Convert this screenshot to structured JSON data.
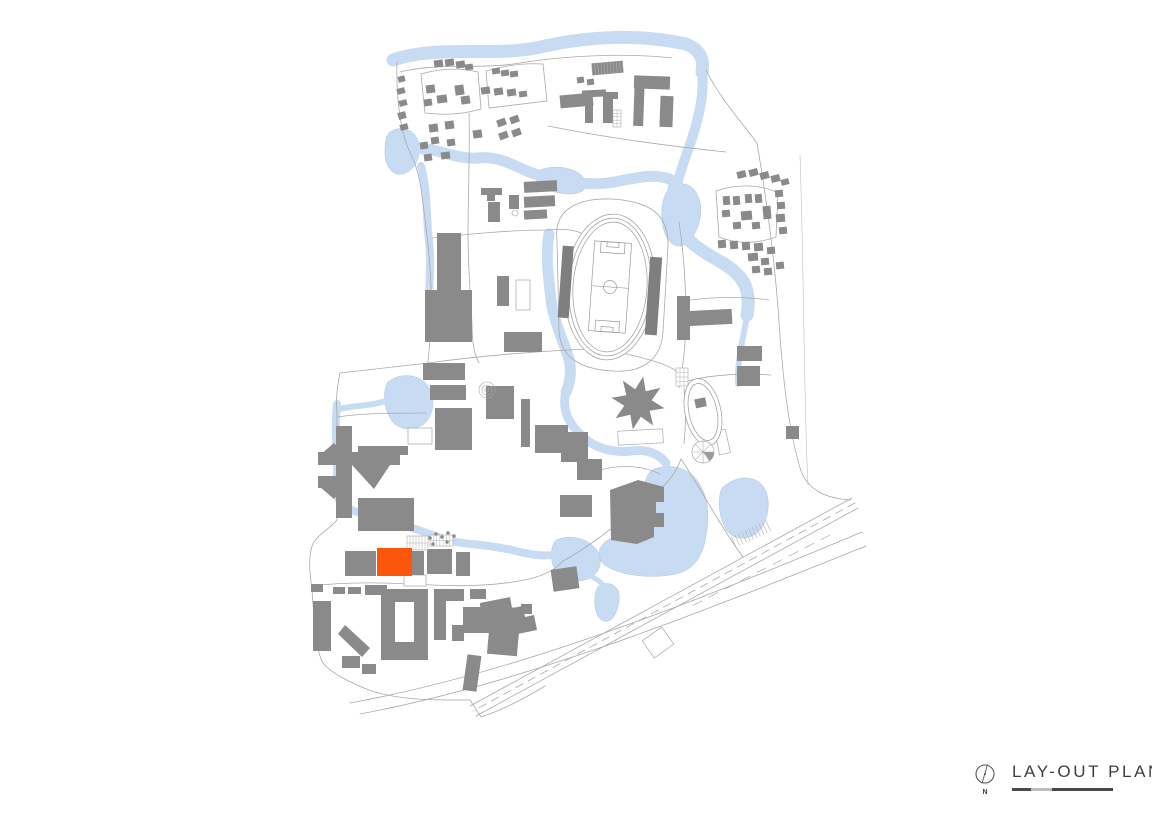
{
  "legend": {
    "title": "LAY-OUT PLAN",
    "north_label": "N"
  },
  "colors": {
    "water": "#C7DCF3",
    "water_edge": "#AFC6DE",
    "building": "#8A8A8A",
    "building_dark": "#7F7F7F",
    "road": "#A9A9A9",
    "road_light": "#BFBFBF",
    "highlight": "#FA560C",
    "text": "#3E3E3E",
    "white": "#FFFFFF"
  },
  "map": {
    "water_fills": [
      "M390,132 C402,124 416,130 419,144 C421,158 414,172 402,174 C391,176 384,164 385,150 C385,142 386,135 390,132 Z",
      "M388,382 C400,372 420,374 428,386 C436,398 434,415 424,424 C412,432 396,430 390,418 C384,408 382,392 388,382 Z",
      "M652,470 C670,462 690,468 699,483 C708,497 710,516 706,536 C703,556 694,570 676,574 C652,579 622,576 606,566 C596,559 597,546 608,540 C622,532 636,524 640,508 C643,492 644,476 652,470 Z",
      "M556,540 C570,534 588,538 597,550 C603,560 601,572 590,578 C578,584 561,580 555,570 C550,561 550,546 556,540 Z",
      "M600,585 C612,580 621,588 619,601 C617,614 612,623 604,621 C596,619 594,606 595,596 C596,590 597,587 600,585 Z",
      "M722,488 C734,476 754,474 763,486 C771,497 769,515 763,526 C756,538 740,542 730,534 C720,526 716,500 722,488 Z",
      "M668,190 C678,180 692,182 698,196 C704,210 700,226 692,238 C684,250 672,248 666,236 C660,224 660,200 668,190 Z",
      "M540,170 C556,164 576,168 584,178 C590,186 584,194 570,194 C556,194 540,188 536,180 C534,175 536,172 540,170 Z"
    ],
    "water_strokes": [
      {
        "d": "M393,60 C440,44 500,58 545,46 C590,36 640,34 686,44 C701,50 704,60 702,72",
        "w": 13
      },
      {
        "d": "M702,70 C705,95 698,122 688,150 C682,167 678,180 674,194",
        "w": 10
      },
      {
        "d": "M676,182 C668,206 674,228 692,243 C708,257 726,262 738,275 C748,285 750,300 747,315",
        "w": 13
      },
      {
        "d": "M747,315 C744,336 737,358 738,384",
        "w": 6
      },
      {
        "d": "M400,150 C432,143 452,160 477,158 C506,155 520,172 546,177 C572,183 592,186 614,182 C636,178 656,172 674,181",
        "w": 11
      },
      {
        "d": "M421,166 C428,192 426,217 429,242 C432,267 428,292 429,314",
        "w": 8
      },
      {
        "d": "M549,234 C545,258 549,280 551,300 C553,318 562,338 568,356 C572,368 571,380 566,392",
        "w": 11
      },
      {
        "d": "M566,392 C561,410 570,425 582,436 C594,448 612,453 631,451 C646,449 658,453 666,463",
        "w": 9
      },
      {
        "d": "M337,404 C334,430 338,458 337,483 C336,499 341,507 349,511",
        "w": 8
      },
      {
        "d": "M388,400 C370,407 352,405 340,409",
        "w": 6
      },
      {
        "d": "M349,509 C369,517 389,521 409,527 C429,533 445,541 463,543 C481,545 501,547 516,551 C531,555 546,557 559,554",
        "w": 8
      },
      {
        "d": "M592,577 C598,580 602,582 605,588",
        "w": 5
      }
    ],
    "roads": [
      {
        "d": "M397,62 C396,96 400,128 408,148 C418,168 420,180 422,196 C426,226 430,256 431,286 C432,316 430,341 428,363 L340,373 C336,393 336,403 337,413 L337,520 C330,529 316,535 312,546 C308,561 310,576 312,589 C314,621 316,651 323,663 C331,673 351,683 369,690 C391,698 421,700 449,700 L470,700 L481,717 C505,709 525,698 545,686"
      },
      {
        "d": "M421,74 C441,68 461,68 478,72 L481,109 C461,115 441,115 425,113 L421,74"
      },
      {
        "d": "M486,71 C506,65 526,63 543,64 L547,101 L489,108 L486,71"
      },
      {
        "d": "M469,113 C470,151 468,201 468,233 C468,263 470,293 472,323 C472,342 474,354 479,363"
      },
      {
        "d": "M432,238 C470,234 510,230 546,230 C562,229 572,229 581,233"
      },
      {
        "d": "M428,363 C480,356 530,352 568,350 C602,348 622,352 650,360 C672,366 681,373 687,381"
      },
      {
        "d": "M557,240 C553,208 580,198 611,199 C648,201 669,213 668,246 L663,332 C661,361 641,373 612,371 C583,369 561,360 559,331 L557,240"
      },
      {
        "d": "M679,222 C685,262 687,302 685,342 C684,362 681,374 679,388"
      },
      {
        "d": "M706,70 C721,100 741,121 757,143"
      },
      {
        "d": "M757,143 C767,202 775,262 779,322 C783,382 789,432 801,471 C809,492 830,499 851,500"
      },
      {
        "d": "M684,301 C710,297 740,296 769,300"
      },
      {
        "d": "M687,381 C711,375 741,373 771,375"
      },
      {
        "d": "M312,586 C352,581 392,583 432,585 C472,587 502,585 529,579 C546,575 556,569 563,561"
      },
      {
        "d": "M563,561 C591,546 621,521 649,499 C669,483 677,471 681,459"
      },
      {
        "d": "M681,459 C693,477 707,501 719,521 C729,537 737,549 743,557"
      },
      {
        "d": "M337,417 C365,413 395,413 426,413"
      },
      {
        "d": "M852,498 L470,706"
      },
      {
        "d": "M858,508 L476,716"
      },
      {
        "d": "M350,703 C520,672 700,600 862,532"
      },
      {
        "d": "M360,714 C530,682 706,610 866,546"
      },
      {
        "d": "M400,72 C440,62 480,70 520,63 C556,57 620,52 672,58"
      },
      {
        "d": "M716,191 C740,183 762,185 778,193 L776,237 C754,245 734,243 719,237 L716,191"
      },
      {
        "d": "M684,388 C686,408 686,426 684,444"
      },
      {
        "d": "M548,126 C608,138 668,146 726,152"
      },
      {
        "d": "M600,470 C622,464 644,466 660,474"
      },
      {
        "d": "M800,155 C802,215 803,275 804,335 C805,395 806,445 808,485",
        "w": 0.6,
        "c": "#C0C0C0"
      },
      {
        "d": "M855,503 L473,711",
        "dash": "8,6"
      },
      {
        "d": "M830,535 L688,608",
        "dash": "10,8",
        "w": 0.7
      }
    ],
    "outlines": [
      [
        408,
        428,
        24,
        16,
        0
      ],
      [
        404,
        575,
        22,
        11,
        0
      ],
      [
        516,
        280,
        14,
        30,
        0
      ],
      [
        646,
        632,
        24,
        21,
        -35
      ],
      [
        618,
        430,
        45,
        14,
        -3
      ],
      [
        717,
        430,
        11,
        24,
        -12
      ]
    ],
    "buildings": [
      [
        398,
        76,
        7,
        6,
        -15
      ],
      [
        397,
        88,
        8,
        6,
        -15
      ],
      [
        399,
        100,
        8,
        6,
        -15
      ],
      [
        398,
        112,
        8,
        7,
        -15
      ],
      [
        400,
        124,
        8,
        6,
        -15
      ],
      [
        434,
        60,
        9,
        7,
        -8
      ],
      [
        445,
        59,
        9,
        7,
        -8
      ],
      [
        456,
        61,
        9,
        7,
        -8
      ],
      [
        465,
        64,
        8,
        6,
        -8
      ],
      [
        492,
        68,
        8,
        6,
        -8
      ],
      [
        501,
        70,
        8,
        6,
        -8
      ],
      [
        510,
        71,
        8,
        6,
        -8
      ],
      [
        426,
        85,
        9,
        8,
        -8
      ],
      [
        437,
        95,
        10,
        8,
        -8
      ],
      [
        424,
        99,
        8,
        7,
        -8
      ],
      [
        455,
        85,
        9,
        10,
        -8
      ],
      [
        461,
        96,
        9,
        8,
        -8
      ],
      [
        481,
        87,
        9,
        7,
        -8
      ],
      [
        494,
        88,
        9,
        7,
        -8
      ],
      [
        507,
        89,
        9,
        7,
        -8
      ],
      [
        519,
        91,
        8,
        6,
        -8
      ],
      [
        429,
        124,
        9,
        8,
        -8
      ],
      [
        445,
        121,
        9,
        8,
        -8
      ],
      [
        431,
        137,
        8,
        7,
        -8
      ],
      [
        447,
        139,
        8,
        7,
        -8
      ],
      [
        420,
        142,
        8,
        7,
        -8
      ],
      [
        424,
        154,
        8,
        7,
        -8
      ],
      [
        441,
        152,
        9,
        7,
        -8
      ],
      [
        473,
        130,
        9,
        8,
        -8
      ],
      [
        497,
        119,
        9,
        7,
        -20
      ],
      [
        510,
        116,
        9,
        7,
        -20
      ],
      [
        499,
        132,
        9,
        7,
        -20
      ],
      [
        512,
        129,
        9,
        7,
        -20
      ],
      [
        560,
        94,
        33,
        13,
        -5
      ],
      [
        577,
        77,
        7,
        6,
        -8
      ],
      [
        587,
        79,
        7,
        6,
        -8
      ],
      [
        582,
        90,
        24,
        7,
        -3
      ],
      [
        585,
        101,
        8,
        22,
        0
      ],
      [
        603,
        94,
        10,
        29,
        0
      ],
      [
        603,
        92,
        15,
        7,
        0
      ],
      [
        592,
        62,
        31,
        12,
        -5
      ],
      [
        634,
        76,
        10,
        50,
        2
      ],
      [
        634,
        76,
        36,
        13,
        2
      ],
      [
        660,
        96,
        13,
        31,
        2
      ],
      [
        481,
        188,
        21,
        7,
        0
      ],
      [
        487,
        195,
        8,
        6,
        0
      ],
      [
        488,
        202,
        12,
        20,
        0
      ],
      [
        509,
        195,
        10,
        14,
        0
      ],
      [
        524,
        181,
        33,
        11,
        -3
      ],
      [
        524,
        196,
        31,
        11,
        -3
      ],
      [
        524,
        210,
        23,
        9,
        -3
      ],
      [
        737,
        171,
        9,
        7,
        -15
      ],
      [
        749,
        169,
        9,
        7,
        -15
      ],
      [
        760,
        172,
        9,
        7,
        -15
      ],
      [
        771,
        175,
        9,
        7,
        -15
      ],
      [
        781,
        179,
        8,
        6,
        -15
      ],
      [
        723,
        196,
        7,
        9,
        -5
      ],
      [
        733,
        196,
        7,
        9,
        -5
      ],
      [
        745,
        194,
        7,
        9,
        -5
      ],
      [
        755,
        194,
        7,
        9,
        -5
      ],
      [
        722,
        210,
        8,
        7,
        -5
      ],
      [
        741,
        211,
        11,
        9,
        -5
      ],
      [
        733,
        222,
        8,
        7,
        -5
      ],
      [
        752,
        222,
        8,
        7,
        -5
      ],
      [
        775,
        190,
        8,
        7,
        -5
      ],
      [
        777,
        202,
        8,
        7,
        -5
      ],
      [
        776,
        214,
        9,
        8,
        -5
      ],
      [
        779,
        227,
        8,
        7,
        -5
      ],
      [
        763,
        206,
        8,
        13,
        -5
      ],
      [
        718,
        240,
        8,
        8,
        -5
      ],
      [
        730,
        241,
        8,
        8,
        -5
      ],
      [
        742,
        242,
        8,
        8,
        -5
      ],
      [
        754,
        243,
        9,
        8,
        -5
      ],
      [
        767,
        247,
        8,
        7,
        -5
      ],
      [
        748,
        253,
        10,
        8,
        -5
      ],
      [
        761,
        258,
        8,
        7,
        -5
      ],
      [
        752,
        266,
        8,
        7,
        -5
      ],
      [
        764,
        268,
        8,
        7,
        -5
      ],
      [
        776,
        262,
        8,
        7,
        -5
      ],
      [
        437,
        233,
        24,
        58,
        0
      ],
      [
        425,
        290,
        47,
        52,
        0
      ],
      [
        497,
        276,
        12,
        30,
        0
      ],
      [
        504,
        332,
        38,
        20,
        0
      ],
      [
        423,
        363,
        42,
        17,
        0
      ],
      [
        430,
        385,
        36,
        15,
        0
      ],
      [
        445,
        425,
        17,
        20,
        0
      ],
      [
        486,
        386,
        28,
        33,
        0
      ],
      [
        521,
        399,
        9,
        48,
        0
      ],
      [
        435,
        408,
        37,
        42,
        0
      ],
      [
        535,
        425,
        33,
        28,
        0
      ],
      [
        561,
        432,
        27,
        30,
        0
      ],
      [
        577,
        459,
        25,
        21,
        0
      ],
      [
        560,
        495,
        32,
        22,
        0
      ],
      [
        336,
        426,
        16,
        92,
        0
      ],
      [
        318,
        452,
        20,
        13,
        0
      ],
      [
        318,
        476,
        20,
        12,
        0
      ],
      [
        352,
        452,
        48,
        13,
        0
      ],
      [
        358,
        446,
        50,
        9,
        0
      ],
      [
        358,
        498,
        56,
        33,
        0
      ],
      [
        345,
        551,
        31,
        25,
        0
      ],
      [
        411,
        551,
        13,
        24,
        0
      ],
      [
        427,
        549,
        25,
        25,
        0
      ],
      [
        456,
        552,
        14,
        24,
        0
      ],
      [
        688,
        310,
        44,
        15,
        -3
      ],
      [
        737,
        346,
        25,
        15,
        0
      ],
      [
        737,
        366,
        23,
        20,
        0
      ],
      [
        677,
        296,
        13,
        44,
        0
      ],
      [
        786,
        426,
        13,
        13,
        0
      ],
      [
        311,
        584,
        12,
        8,
        0
      ],
      [
        333,
        587,
        12,
        7,
        0
      ],
      [
        348,
        587,
        13,
        7,
        0
      ],
      [
        365,
        585,
        22,
        10,
        0
      ],
      [
        313,
        601,
        18,
        50,
        0
      ],
      [
        381,
        589,
        47,
        13,
        0
      ],
      [
        381,
        602,
        14,
        40,
        0
      ],
      [
        414,
        602,
        14,
        40,
        0
      ],
      [
        381,
        642,
        47,
        18,
        0
      ],
      [
        434,
        589,
        30,
        12,
        0
      ],
      [
        434,
        598,
        12,
        42,
        0
      ],
      [
        452,
        625,
        12,
        16,
        0
      ],
      [
        470,
        589,
        16,
        10,
        0
      ],
      [
        463,
        607,
        36,
        26,
        0
      ],
      [
        489,
        607,
        30,
        48,
        5
      ],
      [
        465,
        655,
        14,
        36,
        8
      ],
      [
        521,
        604,
        11,
        10,
        0
      ],
      [
        342,
        656,
        18,
        12,
        0
      ],
      [
        362,
        664,
        14,
        10,
        0
      ],
      [
        552,
        568,
        26,
        22,
        -8
      ]
    ],
    "building_paths": [
      "M345,625 L370,648 L362,657 L338,634 Z",
      "M352,465 L392,462 L374,489 Z",
      "M320,455 L334,443 L341,451 L327,463 Z",
      "M320,487 L334,499 L341,491 L327,479 Z",
      "M664.5,408.2 L649.7,410.7 L653.1,425.4 L640.8,416.7 L632.8,429.5 L630.3,414.7 L615.6,418.1 L624.3,405.8 L611.5,397.8 L626.3,395.3 L622.9,380.6 L635.2,389.3 L643.2,376.5 L645.7,391.3 L660.4,387.9 L651.7,400.2 Z",
      "M610,490 L638,480 L664,487 L664,502 L656,502 L656,513 L664,513 L664,527 L654,527 L654,537 L637,544 L611,540 Z",
      "M480,603 L510,597 L512,608 L523,606 L525,617 L534,615 L537,630 L498,638 L481,629 Z"
    ],
    "stadium": {
      "cx": 610,
      "cy": 287,
      "rot": 4,
      "rings": [
        [
          45,
          73
        ],
        [
          41,
          69
        ],
        [
          37,
          65
        ]
      ],
      "field": [
        591.5,
        242,
        37,
        90
      ],
      "boxes": [
        [
          598,
          242,
          24,
          11
        ],
        [
          604,
          242,
          12,
          5
        ],
        [
          598,
          321,
          24,
          11
        ],
        [
          604,
          327,
          12,
          5
        ]
      ],
      "center_circle_r": 6.5,
      "stands": [
        [
          560,
          249,
          11,
          72
        ],
        [
          648,
          254,
          12,
          78
        ]
      ]
    },
    "oval": {
      "cx": 703,
      "cy": 412,
      "rot": -12,
      "rings": [
        [
          18,
          34
        ],
        [
          14,
          29
        ]
      ],
      "building": [
        697,
        398,
        11,
        9
      ]
    },
    "fan": {
      "cx": 703,
      "cy": 452,
      "r": 11,
      "spokes": "M692,452 L714,452 M703,441 L703,463 M695.2,444.2 L710.8,459.8 M695.2,459.8 L710.8,444.2",
      "wedge": "M703,452 L714,452 A11,11 0 0 1 709.3,461 Z"
    },
    "courts": [
      {
        "x": 407,
        "y": 536,
        "w": 21,
        "h": 14,
        "cols": 7,
        "rows": 2,
        "rot": 0
      },
      {
        "x": 430,
        "y": 535,
        "w": 23,
        "h": 11,
        "cols": 7,
        "rows": 2,
        "rot": 0
      },
      {
        "x": 613,
        "y": 110,
        "w": 8,
        "h": 17,
        "cols": 2,
        "rows": 5,
        "rot": 0
      },
      {
        "x": 676,
        "y": 368,
        "w": 12,
        "h": 18,
        "cols": 3,
        "rows": 4,
        "rot": 0
      }
    ],
    "stripes": [
      {
        "x": 592,
        "y": 62,
        "w": 31,
        "h": 12,
        "n": 10,
        "rot": -5,
        "c": "#B0B0B0"
      },
      {
        "x": 732,
        "y": 528,
        "w": 38,
        "h": 12,
        "n": 10,
        "rot": -25,
        "c": "#B5B5B5"
      }
    ],
    "circles": [
      {
        "cx": 487,
        "cy": 390,
        "r": 8
      },
      {
        "cx": 487,
        "cy": 390,
        "r": 5
      },
      {
        "cx": 487,
        "cy": 390,
        "r": 2
      },
      {
        "cx": 515,
        "cy": 213,
        "r": 3
      }
    ],
    "trees": [
      [
        430,
        538
      ],
      [
        436,
        534
      ],
      [
        442,
        537
      ],
      [
        448,
        533
      ],
      [
        454,
        536
      ],
      [
        433,
        544
      ],
      [
        447,
        542
      ]
    ],
    "highlight": [
      377,
      548,
      35,
      28
    ]
  }
}
